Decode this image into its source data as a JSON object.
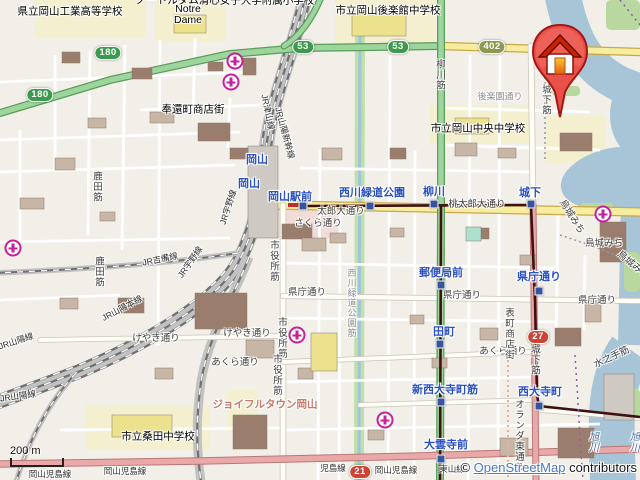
{
  "map": {
    "attribution": {
      "copyright": "© ",
      "link_text": "OpenStreetMap",
      "suffix": " contributors"
    },
    "scale_bar": {
      "label": "200 m"
    },
    "badges": [
      {
        "t": "180",
        "x": 108,
        "y": 53,
        "kind": "green"
      },
      {
        "t": "180",
        "x": 40,
        "y": 95,
        "kind": "green"
      },
      {
        "t": "53",
        "x": 303,
        "y": 47,
        "kind": "green"
      },
      {
        "t": "53",
        "x": 398,
        "y": 47,
        "kind": "green"
      },
      {
        "t": "402",
        "x": 492,
        "y": 47,
        "kind": "olive"
      },
      {
        "t": "27",
        "x": 538,
        "y": 337,
        "kind": "red"
      },
      {
        "t": "21",
        "x": 360,
        "y": 472,
        "kind": "red"
      }
    ],
    "stops": [
      {
        "x": 303,
        "y": 206
      },
      {
        "x": 370,
        "y": 206
      },
      {
        "x": 434,
        "y": 204
      },
      {
        "x": 531,
        "y": 204
      },
      {
        "x": 441,
        "y": 285
      },
      {
        "x": 539,
        "y": 291
      },
      {
        "x": 440,
        "y": 344
      },
      {
        "x": 441,
        "y": 402
      },
      {
        "x": 539,
        "y": 406
      },
      {
        "x": 441,
        "y": 459
      }
    ],
    "hospitals": [
      {
        "x": 235,
        "y": 61
      },
      {
        "x": 231,
        "y": 82
      },
      {
        "x": 13,
        "y": 248
      },
      {
        "x": 297,
        "y": 335
      },
      {
        "x": 385,
        "y": 420
      },
      {
        "x": 603,
        "y": 214
      }
    ],
    "labels": [
      {
        "t": "県立岡山工業高等学校",
        "x": 70,
        "y": 11,
        "cls": "place"
      },
      {
        "t": "ノートルダム清心女子大学附属小学校",
        "x": 225,
        "y": 0,
        "cls": "place"
      },
      {
        "t": "Notre",
        "x": 188,
        "y": 9,
        "cls": "place"
      },
      {
        "t": "Dame",
        "x": 188,
        "y": 20,
        "cls": "place"
      },
      {
        "t": "市立岡山後楽館中学校",
        "x": 388,
        "y": 10,
        "cls": "place"
      },
      {
        "t": "奉還町商店街",
        "x": 193,
        "y": 109,
        "cls": "place"
      },
      {
        "t": "市立岡山中央中学校",
        "x": 478,
        "y": 128,
        "cls": "place"
      },
      {
        "t": "市立桑田中学校",
        "x": 158,
        "y": 436,
        "cls": "place"
      },
      {
        "t": "ジョイフルタウン岡山",
        "x": 265,
        "y": 404,
        "cls": "complex"
      },
      {
        "t": "岡山",
        "x": 257,
        "y": 159,
        "cls": "station"
      },
      {
        "t": "岡山",
        "x": 249,
        "y": 183,
        "cls": "station"
      },
      {
        "t": "岡山駅前",
        "x": 290,
        "y": 196,
        "cls": "station"
      },
      {
        "t": "西川緑道公園",
        "x": 372,
        "y": 192,
        "cls": "station"
      },
      {
        "t": "柳川",
        "x": 434,
        "y": 191,
        "cls": "station"
      },
      {
        "t": "城下",
        "x": 530,
        "y": 192,
        "cls": "station"
      },
      {
        "t": "郵便局前",
        "x": 441,
        "y": 272,
        "cls": "station"
      },
      {
        "t": "県庁通り",
        "x": 539,
        "y": 276,
        "cls": "station"
      },
      {
        "t": "田町",
        "x": 444,
        "y": 331,
        "cls": "station"
      },
      {
        "t": "新西大寺町筋",
        "x": 445,
        "y": 389,
        "cls": "station"
      },
      {
        "t": "西大寺町",
        "x": 540,
        "y": 391,
        "cls": "station"
      },
      {
        "t": "大雲寺前",
        "x": 446,
        "y": 444,
        "cls": "station"
      },
      {
        "t": "桃太郎大通り",
        "x": 477,
        "y": 203,
        "cls": "street"
      },
      {
        "t": "太郎大通り",
        "x": 341,
        "y": 210,
        "cls": "street"
      },
      {
        "t": "さくら通り",
        "x": 318,
        "y": 222,
        "cls": "street"
      },
      {
        "t": "柳川筋",
        "x": 439,
        "y": 75,
        "cls": "street",
        "vert": true
      },
      {
        "t": "市役所筋",
        "x": 273,
        "y": 261,
        "cls": "street",
        "vert": true
      },
      {
        "t": "市役所筋",
        "x": 281,
        "y": 338,
        "cls": "street",
        "vert": true
      },
      {
        "t": "市役所筋",
        "x": 276,
        "y": 375,
        "cls": "street",
        "vert": true
      },
      {
        "t": "県庁通り",
        "x": 462,
        "y": 294,
        "cls": "street"
      },
      {
        "t": "県庁通り",
        "x": 597,
        "y": 299,
        "cls": "street"
      },
      {
        "t": "県庁通り",
        "x": 307,
        "y": 291,
        "cls": "street"
      },
      {
        "t": "けやき通り",
        "x": 156,
        "y": 337,
        "cls": "street"
      },
      {
        "t": "けやき通り",
        "x": 247,
        "y": 332,
        "cls": "street"
      },
      {
        "t": "あくら通り",
        "x": 235,
        "y": 361,
        "cls": "street"
      },
      {
        "t": "あくら通り",
        "x": 503,
        "y": 350,
        "cls": "street"
      },
      {
        "t": "烏城みち",
        "x": 573,
        "y": 216,
        "cls": "street",
        "rot": 58
      },
      {
        "t": "烏城みち",
        "x": 604,
        "y": 242,
        "cls": "street"
      },
      {
        "t": "烏城みち",
        "x": 634,
        "y": 264,
        "cls": "street",
        "rot": 40
      },
      {
        "t": "城下筋",
        "x": 545,
        "y": 100,
        "cls": "street",
        "vert": true
      },
      {
        "t": "城下筋",
        "x": 534,
        "y": 360,
        "cls": "street",
        "vert": true
      },
      {
        "t": "後楽園通り",
        "x": 500,
        "y": 96,
        "cls": "street-faint"
      },
      {
        "t": "水之手筋",
        "x": 611,
        "y": 356,
        "cls": "street",
        "rot": -25
      },
      {
        "t": "オランダ東通り",
        "x": 518,
        "y": 436,
        "cls": "street",
        "vert": true
      },
      {
        "t": "表町商店街",
        "x": 508,
        "y": 334,
        "cls": "street",
        "vert": true
      },
      {
        "t": "西川緑道公園筋",
        "x": 352,
        "y": 303,
        "cls": "street-faint",
        "vert": true
      },
      {
        "t": "鹿田筋",
        "x": 96,
        "y": 187,
        "cls": "street",
        "vert": true
      },
      {
        "t": "鹿田筋",
        "x": 98,
        "y": 272,
        "cls": "street",
        "vert": true
      },
      {
        "t": "JR津山線",
        "x": 268,
        "y": 112,
        "cls": "rail",
        "rot": 78
      },
      {
        "t": "JR山陽新幹線",
        "x": 285,
        "y": 133,
        "cls": "rail",
        "rot": 75
      },
      {
        "t": "JR吉備線",
        "x": 160,
        "y": 259,
        "cls": "rail",
        "rot": -12
      },
      {
        "t": "JR宇野線",
        "x": 190,
        "y": 262,
        "cls": "rail",
        "rot": -55
      },
      {
        "t": "JR宇野線",
        "x": 228,
        "y": 207,
        "cls": "rail",
        "rot": -72
      },
      {
        "t": "JR山陽本線",
        "x": 122,
        "y": 308,
        "cls": "rail",
        "rot": -28
      },
      {
        "t": "JR山陽線",
        "x": 16,
        "y": 341,
        "cls": "rail",
        "rot": -18
      },
      {
        "t": "JR山陽線",
        "x": 18,
        "y": 396,
        "cls": "rail",
        "rot": -8
      },
      {
        "t": "岡山児島線",
        "x": 125,
        "y": 471,
        "cls": "rail"
      },
      {
        "t": "岡山児島線",
        "x": 396,
        "y": 470,
        "cls": "rail"
      },
      {
        "t": "岡山児島線",
        "x": 50,
        "y": 474,
        "cls": "rail"
      },
      {
        "t": "児島線",
        "x": 333,
        "y": 468,
        "cls": "rail"
      },
      {
        "t": "東山線",
        "x": 452,
        "y": 469,
        "cls": "rail"
      },
      {
        "t": "旭川",
        "x": 592,
        "y": 442,
        "cls": "water",
        "vert": true
      },
      {
        "t": "旭川",
        "x": 633,
        "y": 442,
        "cls": "water",
        "vert": true
      }
    ]
  }
}
